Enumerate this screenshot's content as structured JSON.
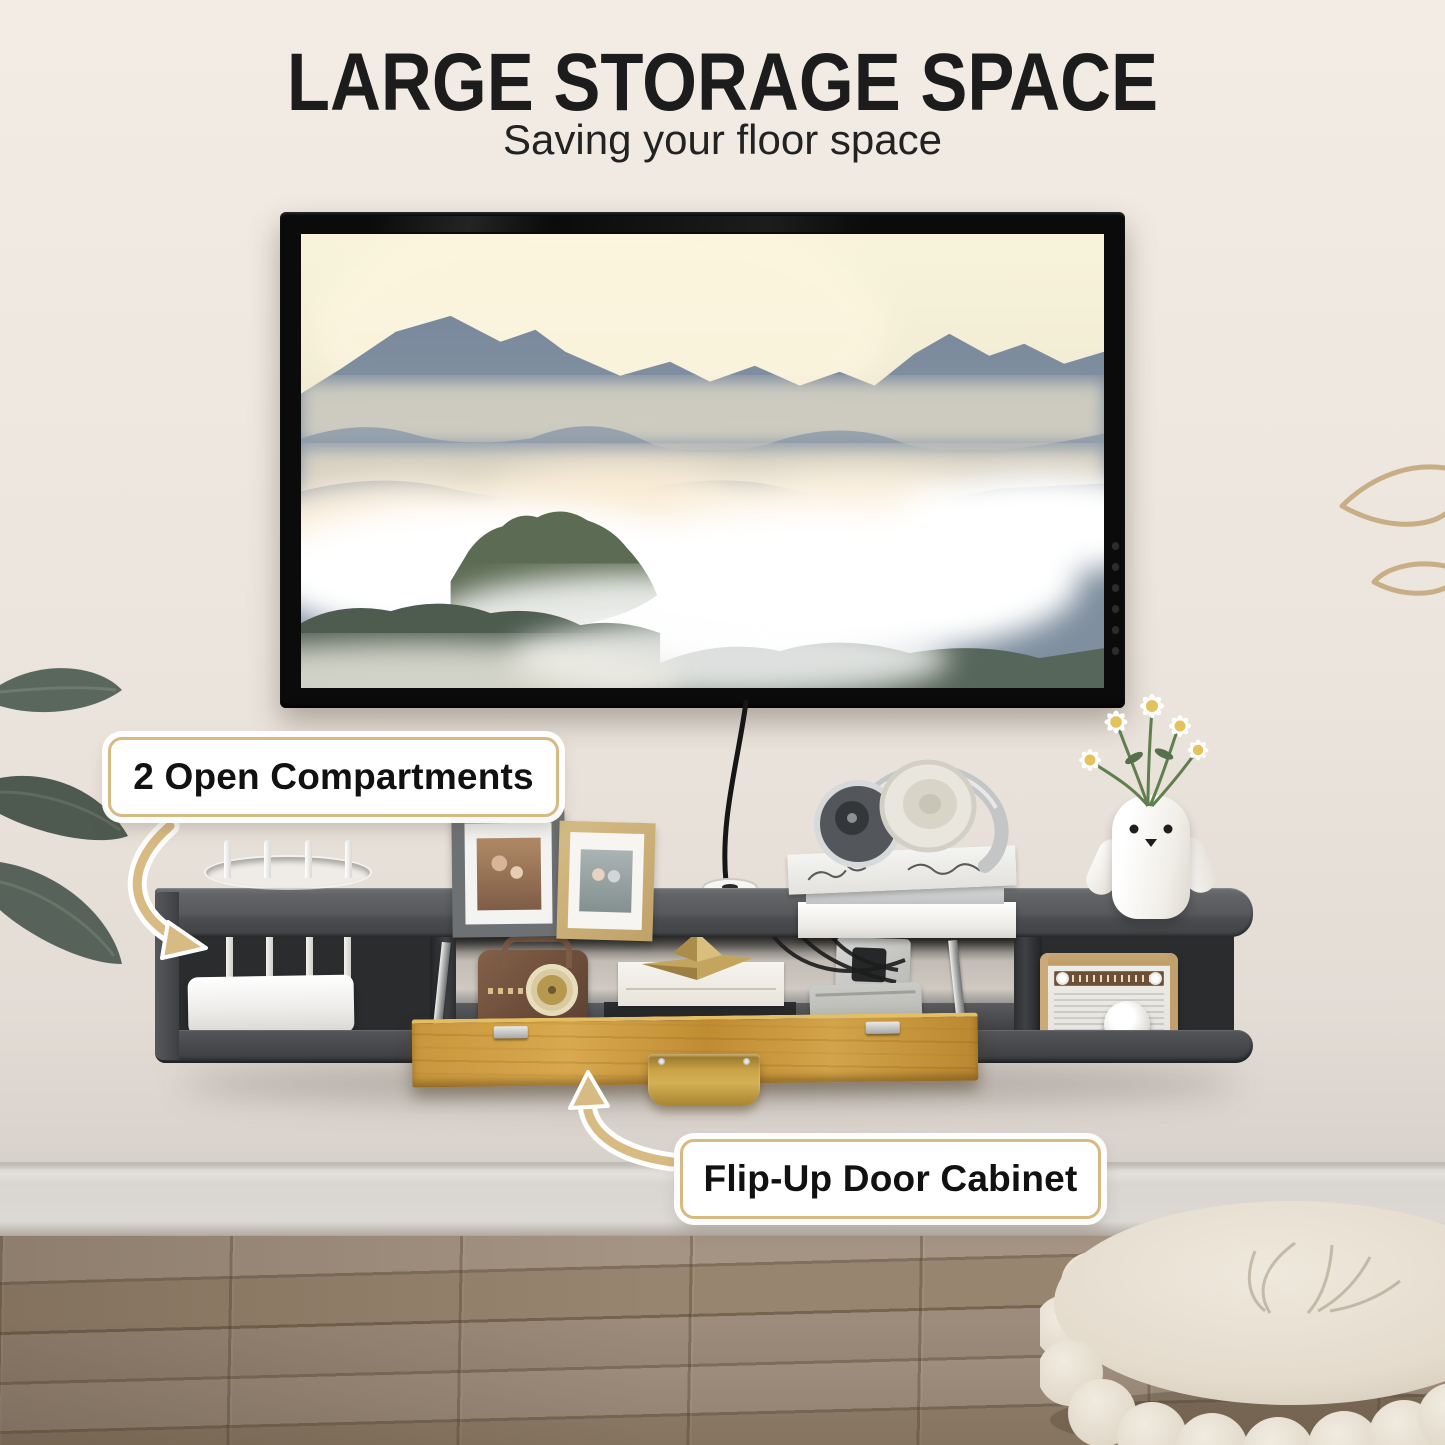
{
  "header": {
    "title": "LARGE STORAGE SPACE",
    "subtitle": "Saving your floor space"
  },
  "callouts": {
    "open_compartments": "2 Open Compartments",
    "flip_up_door": "Flip-Up Door Cabinet"
  },
  "icons": {
    "open_compartments_arrow": "curved-arrow-down-right-icon",
    "flip_door_arrow": "curved-arrow-up-icon"
  },
  "colors": {
    "accent-gold": "#d7ba81",
    "text-dark": "#1c1c1c",
    "wall-top": "#f2ece4",
    "wall-bottom": "#d8d2cc",
    "shelf-gray": "#56585b",
    "shelf-dark": "#3e4043",
    "door-wood": "#c9963b",
    "handle-gold": "#c29c44",
    "floor-wood": "#9d8c7b",
    "baseboard": "#dcd8d3"
  }
}
